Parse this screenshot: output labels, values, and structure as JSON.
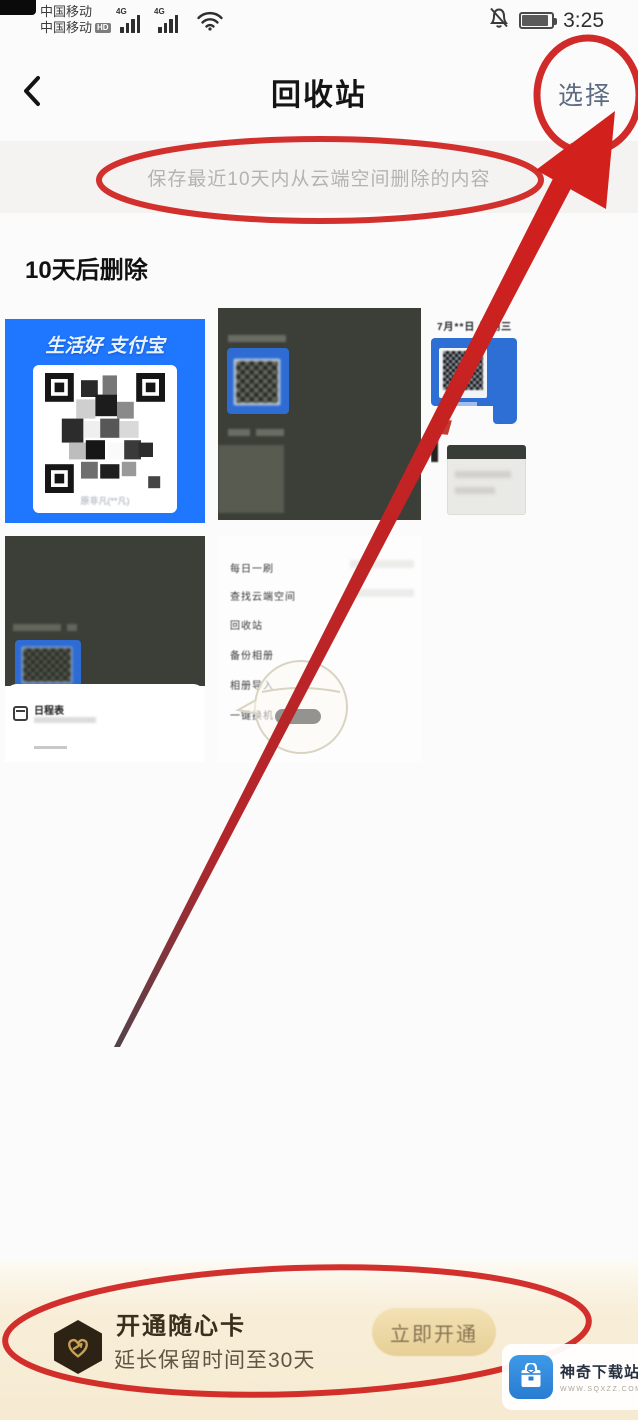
{
  "status_bar": {
    "carrier_line1": "中国移动",
    "carrier_line2": "中国移动",
    "hd_badge": "HD",
    "network_type": "4G",
    "time": "3:25"
  },
  "nav": {
    "title": "回收站",
    "select_label": "选择"
  },
  "notice_banner": {
    "text": "保存最近10天内从云端空间删除的内容"
  },
  "section_heading": "10天后删除",
  "thumbnails": {
    "alipay_qr": {
      "brand": "生活好 支付宝",
      "caption": "原非凡(**凡)"
    },
    "date_screenshot": {
      "date_text": "7月**日 星期三"
    },
    "schedule_sheet": {
      "title": "日程表"
    },
    "settings_menu": {
      "items": [
        "每日一刷",
        "查找云端空间",
        "回收站",
        "备份相册",
        "相册导入",
        "一键换机"
      ]
    }
  },
  "promo": {
    "title": "开通随心卡",
    "subtitle": "延长保留时间至30天",
    "button_label": "立即开通"
  },
  "watermark": {
    "site_name": "神奇下载站",
    "site_url": "WWW.SQXZZ.COM"
  },
  "colors": {
    "annotation_red": "#d02020",
    "accent_blue": "#1e77fe",
    "select_label": "#5d6b82",
    "promo_bg": "#f6ead1",
    "notice_bg": "#f4f3f2"
  }
}
